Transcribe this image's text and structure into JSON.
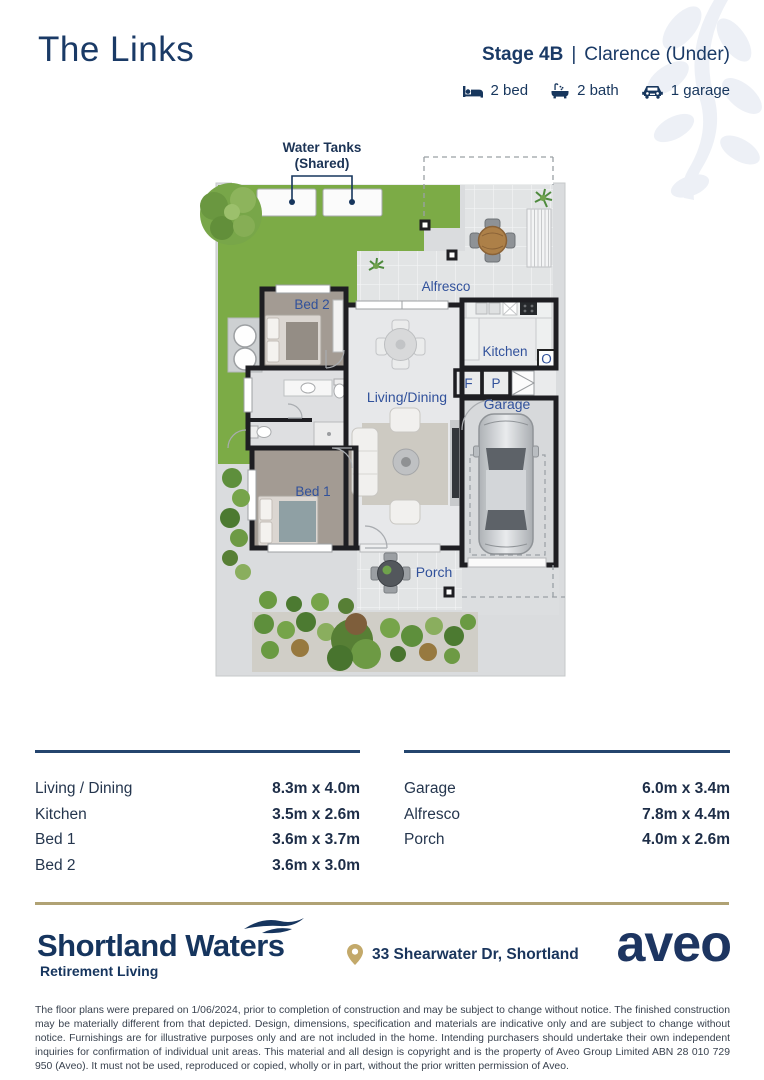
{
  "header": {
    "title": "The Links",
    "stage": "Stage 4B",
    "divider": "|",
    "variant": "Clarence (Under)",
    "features": [
      {
        "icon": "bed-icon",
        "label": "2 bed"
      },
      {
        "icon": "bath-icon",
        "label": "2 bath"
      },
      {
        "icon": "garage-icon",
        "label": "1 garage"
      }
    ]
  },
  "floorplan": {
    "annotation_line1": "Water Tanks",
    "annotation_line2": "(Shared)",
    "rooms": {
      "alfresco": "Alfresco",
      "kitchen": "Kitchen",
      "living_dining": "Living/Dining",
      "garage": "Garage",
      "bed1": "Bed 1",
      "bed2": "Bed 2",
      "porch": "Porch",
      "fridge_abbr": "F",
      "pantry_abbr": "P",
      "oven_abbr": "O"
    }
  },
  "dimensions": {
    "left": [
      {
        "room": "Living / Dining",
        "size": "8.3m x 4.0m"
      },
      {
        "room": "Kitchen",
        "size": "3.5m x 2.6m"
      },
      {
        "room": "Bed 1",
        "size": "3.6m x 3.7m"
      },
      {
        "room": "Bed 2",
        "size": "3.6m x 3.0m"
      }
    ],
    "right": [
      {
        "room": "Garage",
        "size": "6.0m x 3.4m"
      },
      {
        "room": "Alfresco",
        "size": "7.8m x 4.4m"
      },
      {
        "room": "Porch",
        "size": "4.0m x 2.6m"
      }
    ]
  },
  "footer": {
    "community": "Shortland Waters",
    "tagline": "Retirement Living",
    "address": "33 Shearwater Dr, Shortland",
    "brand": "aveo",
    "disclaimer": "The floor plans were prepared on 1/06/2024, prior to completion of construction and may be subject to change without notice. The finished construction may be materially different from that depicted. Design, dimensions, specification and materials are indicative only and are subject to change without notice. Furnishings are for illustrative purposes only and are not included in the home. Intending purchasers should undertake their own independent inquiries for confirmation of individual unit areas. This material and all design is copyright and is the property of Aveo Group Limited ABN 28 010 729 950 (Aveo). It must not be used, reproduced or copied, wholly or in part, without the prior written permission of Aveo."
  },
  "colors": {
    "brand_navy": "#17365d",
    "plan_label_blue": "#31519b",
    "gold": "#b0a274",
    "lawn_green": "#7cab46"
  }
}
